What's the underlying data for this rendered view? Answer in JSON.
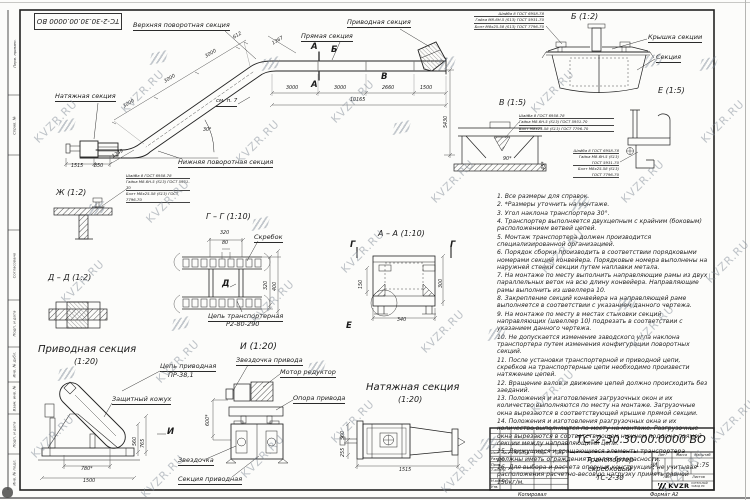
{
  "stamp_top": "ТС-2-30.30.00.0000 ВО",
  "watermark": {
    "text": "KVZR.RU"
  },
  "specs": [
    "Шайба 8 ГОСТ 6958-78",
    "Гайка М8-6Н.5 (S13) ГОСТ 5931-70",
    "Болт М8х25.58 (S13) ГОСТ 7796-70"
  ],
  "main_view": {
    "labels": {
      "upper_turn": "Верхняя поворотная секция",
      "straight": "Прямая секция",
      "drive": "Приводная секция",
      "tension": "Натяжная секция",
      "lower_turn": "Нижняя поворотная секция",
      "see_note": "см. п. 7"
    },
    "marks": {
      "a": "А",
      "b": "Б",
      "v": "В"
    },
    "dims": {
      "top_row": [
        "3000",
        "3000",
        "2660",
        "1500"
      ],
      "total": "10165",
      "upper": "1367",
      "incline": [
        "612",
        "3000",
        "3000",
        "3000"
      ],
      "height": "5430",
      "bottom": [
        "1515",
        "850",
        "1249"
      ],
      "angle": "30°"
    }
  },
  "views": {
    "zh": {
      "title": "Ж  (1:2)"
    },
    "gg": {
      "title": "Г  –  Г  (1:10)",
      "scraper": "Скребок",
      "chain1": "Цепь транспортерная",
      "chain2": "Р2-80-290",
      "mark_d": "Д",
      "dims": {
        "d320t": "320",
        "d80": "80",
        "d320r": "320",
        "d400": "400"
      }
    },
    "aa": {
      "title": "А  –  А  (1:10)",
      "mark_g": "Г",
      "mark_e": "Е",
      "dims": {
        "d150": "150",
        "d340": "340",
        "d300": "300"
      }
    },
    "dd": {
      "title": "Д  –  Д  (1:2)"
    },
    "b": {
      "title": "Б  (1:2)",
      "cover": "Крышка секции",
      "section": "Секция"
    },
    "v": {
      "title": "В  (1:5)",
      "dim_angle": "90*",
      "dim_45": "45*"
    },
    "e": {
      "title": "Е  (1:5)"
    },
    "drive": {
      "title": "Приводная секция",
      "scale": "(1:20)",
      "chain1": "Цепь приводная",
      "chain2": "ПР-38,1",
      "casing": "Защитный кожух",
      "mark_i": "И",
      "dims": {
        "w1": "780*",
        "w2": "1500",
        "h1": "560",
        "h2": "765"
      }
    },
    "i": {
      "title": "И  (1:20)",
      "sprocket_drive": "Звездочка привода",
      "motor": "Мотор редуктор",
      "support": "Опора привода",
      "sprocket": "Звездочка",
      "section": "Секция приводная",
      "dim_h": "600*"
    },
    "tension": {
      "title": "Натяжная секция",
      "scale": "(1:20)",
      "dim": "1515",
      "dims_side": [
        "560",
        "255"
      ]
    }
  },
  "notes": {
    "items": [
      "1. Все размеры для справок.",
      "2. *Размеры уточнить на монтаже.",
      "3. Угол наклона транспортера 30°.",
      "4. Транспортер выполняется двухцепным с крайним (боковым) расположением ветвей цепей.",
      "5. Монтаж транспортера должен производится специализированной организацией.",
      "6. Порядок сборки производить в соответствии порядковыми номерами секций конвейера. Порядковые номера выполнены на наружней стенки секции путем наплавки метала.",
      "7. На монтаже по месту выполнить направляющие рамы из двух параллельных веток на всю длину конвейера. Направляющие рамы выполнить из швеллера 10.",
      "8. Закрепление секций конвейера на направляющей раме выполняется в соответствии с указанием данного чертежа.",
      "9. На монтаже по месту в местах стыковки секций направляющих (швеллер 10) подрезать в соответствии с указанием данного чертежа.",
      "10. Не допускается изменение заводского угла наклона транспортера путем изменения конфигурации поворотных секций.",
      "11. После установки транспортерной и приводной цепи, скребков на транспортерные цепи необходимо произвести натяжение цепей.",
      "12. Вращение валов и движение цепей должно происходить без заеданий.",
      "13. Положения и изготовления загрузочных окон и их количество выполняются по месту на монтаже. Загрузочные окна вырезаются в соответствующей крышке прямой секции.",
      "14. Положения и изготовления разгрузочных окна и их количество выполняются по месту на монтаже. Разгрузочные окна вырезаются в соответствующем нижнем поддоне прямой секции между направляющими цепи.",
      "15. Движущиеся и вращающиеся элементы транспортера должны иметь ограждения в целях безопасности.",
      "16. Для выбора и расчета опорных конструкций, не учитывая расположения расчетно-весовую нагрузку принять равной 150кг/м."
    ]
  },
  "title_block": {
    "doc_number": "ТС-2-30.30.00.0000  ВО",
    "name1": "Транспортер",
    "name2": "скребковый",
    "name3": "ТС-2-30",
    "lit_header": "Лит.",
    "mass_header": "Масса",
    "scale_header": "Масштаб",
    "lit": "И",
    "scale": "1:75",
    "sheet_header": "Лист",
    "sheets_header": "Листов",
    "col_izm": "Изм.",
    "col_list": "Лист",
    "col_doc": "№ докум.",
    "col_sign": "Подп.",
    "col_date": "Дата",
    "row_razrab": "Разраб.",
    "row_prov": "Пров.",
    "row_tkontr": "Т.контр.",
    "row_nkontr": "Н.контр.",
    "row_utv": "Утв.",
    "logo_text": "KVZR",
    "logo_sub1": "КОТЕЛЬНЫЙ",
    "logo_sub2": "ЗАВОД РФ"
  },
  "frame_fields": [
    "Перв. примен.",
    "Справ. №",
    "Согласовано",
    "Подп. и дата",
    "Инв. № дубл.",
    "Взам. инв. №",
    "Подп. и дата",
    "Инв. № подл."
  ],
  "footer": {
    "copied": "Копировал",
    "format": "Формат А2"
  }
}
